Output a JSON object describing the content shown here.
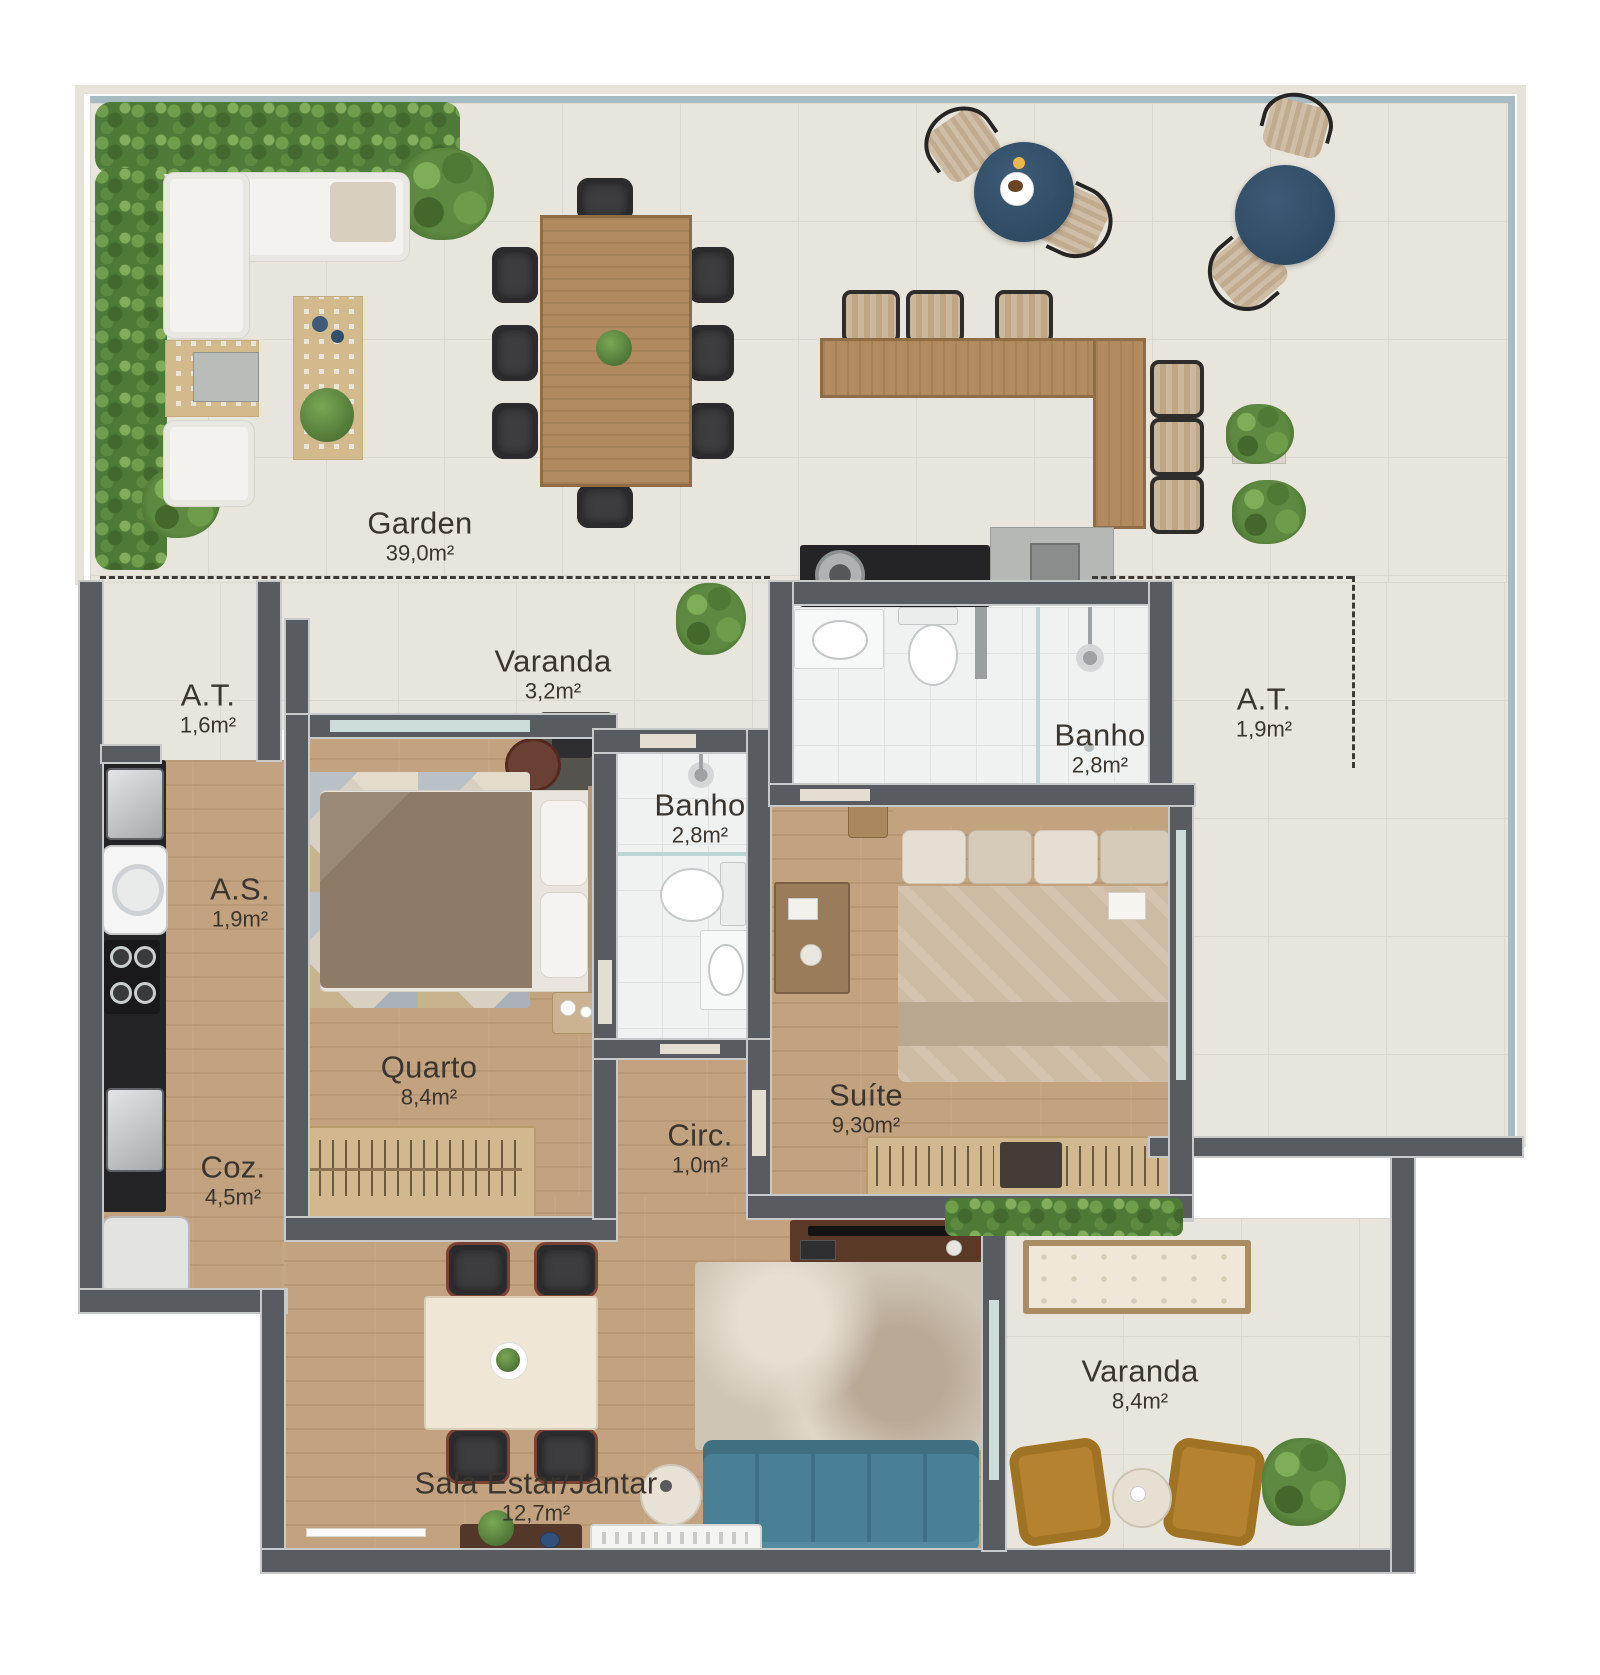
{
  "rooms": {
    "garden": {
      "name": "Garden",
      "area": "39,0m²"
    },
    "at1": {
      "name": "A.T.",
      "area": "1,6m²"
    },
    "varanda_top": {
      "name": "Varanda",
      "area": "3,2m²"
    },
    "banho1": {
      "name": "Banho",
      "area": "2,8m²"
    },
    "banho2": {
      "name": "Banho",
      "area": "2,8m²"
    },
    "at2": {
      "name": "A.T.",
      "area": "1,9m²"
    },
    "as": {
      "name": "A.S.",
      "area": "1,9m²"
    },
    "quarto": {
      "name": "Quarto",
      "area": "8,4m²"
    },
    "circ": {
      "name": "Circ.",
      "area": "1,0m²"
    },
    "suite": {
      "name": "Suíte",
      "area": "9,30m²"
    },
    "coz": {
      "name": "Coz.",
      "area": "4,5m²"
    },
    "varanda_bottom": {
      "name": "Varanda",
      "area": "8,4m²"
    },
    "sala": {
      "name": "Sala Estar/Jantar",
      "area": "12,7m²"
    }
  },
  "colors": {
    "wall": "#585b60",
    "wood_floor": "#c2a27f",
    "terrace_tile": "#e8e5dc",
    "bath_tile": "#f0f2f2",
    "accent_navy": "#35516c",
    "sofa_teal": "#4a8095",
    "armchair_mustard": "#b5832f",
    "plant_green": "#5d8a40",
    "perimeter_line": "#a7bbc2"
  }
}
